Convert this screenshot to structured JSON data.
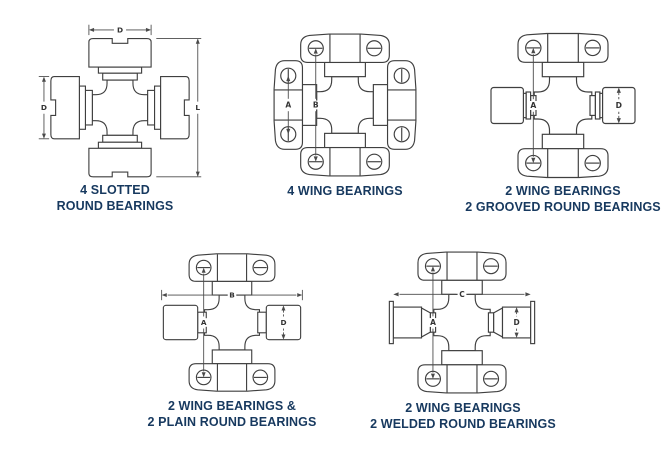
{
  "title": "Universal joint bearing style diagrams",
  "colors": {
    "background": "#ffffff",
    "caption_text": "#17395f",
    "drawing_line": "#3f3f3f",
    "dimension_line": "#4a4a4a"
  },
  "diagrams": [
    {
      "caption_line1": "4 SLOTTED",
      "caption_line2": "ROUND BEARINGS",
      "dims": {
        "width": "D",
        "diameter": "D",
        "length": "L"
      }
    },
    {
      "caption_line1": "4 WING BEARINGS",
      "caption_line2": "",
      "dims": {
        "lug_span": "A",
        "overall": "B"
      }
    },
    {
      "caption_line1": "2 WING BEARINGS",
      "caption_line2": "2 GROOVED ROUND BEARINGS",
      "dims": {
        "overall": "A",
        "diameter": "D"
      }
    },
    {
      "caption_line1": "2 WING BEARINGS &",
      "caption_line2": "2 PLAIN ROUND BEARINGS",
      "dims": {
        "overall_width": "B",
        "overall": "A",
        "diameter": "D"
      }
    },
    {
      "caption_line1": "2 WING BEARINGS",
      "caption_line2": "2 WELDED ROUND BEARINGS",
      "dims": {
        "overall_width": "C",
        "overall": "A",
        "diameter": "D"
      }
    }
  ]
}
